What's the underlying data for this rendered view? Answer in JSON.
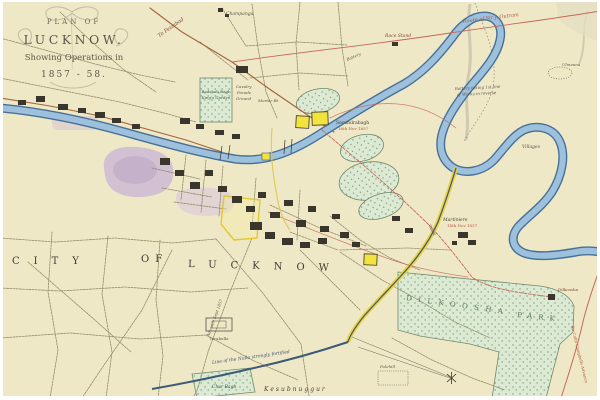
{
  "map": {
    "title": {
      "plan_of": "PLAN OF",
      "name": "LUCKNOW.",
      "subtitle": "Showing Operations in",
      "years": "1857 - 58."
    },
    "regions": {
      "city_word1": "CITY",
      "city_word2": "OF",
      "city_word3": "LUCKNOW",
      "dilkoosha_word1": "DILKOOSHA",
      "dilkoosha_word2": "PARK",
      "kesubnuggur": "Kesubnuggur"
    },
    "labels": {
      "to_feizabad": "To Feizabad",
      "champanga": "Champanga",
      "race_stand": "Race Stand",
      "outram_route": "Route of Sir J. Outram",
      "battery": "Battery",
      "battery_note_1": "Battery taking 1st line",
      "battery_note_2": "of Works in reverse",
      "ulmeana": "Ulmeana",
      "badshah_1": "Badshah Bagh",
      "badshah_2": "King's Garden",
      "cavalry_1": "Cavalry",
      "cavalry_2": "Parade",
      "cavalry_3": "Ground",
      "mortar": "Mortar Bt",
      "secundra": "Secundrabagh",
      "secundra_date": "16th Nov 1857",
      "villages": "Villages",
      "martiniere": "Martiniere",
      "martiniere_date": "14th Nov 1857",
      "dilkoosha_house": "Dilkoosha",
      "advance_sept": "Advance Sept 1857",
      "nulla": "Line of the Nulla strongly fortified",
      "char_bagh": "Char Bagh",
      "terahulla": "Terahulla",
      "polehill": "Polehill",
      "colin": "Sir Colin Campbells Advance",
      "canal": "Canal"
    },
    "colors": {
      "paper": "#efe8c6",
      "river": "#9dc0dc",
      "river_edge": "#477099",
      "park_green": "#dcead4",
      "city_wash": "#cbb6d4",
      "route_red": "#c4685a",
      "canal_yellow": "#e6d23c",
      "road_brown": "#a2653f"
    }
  }
}
